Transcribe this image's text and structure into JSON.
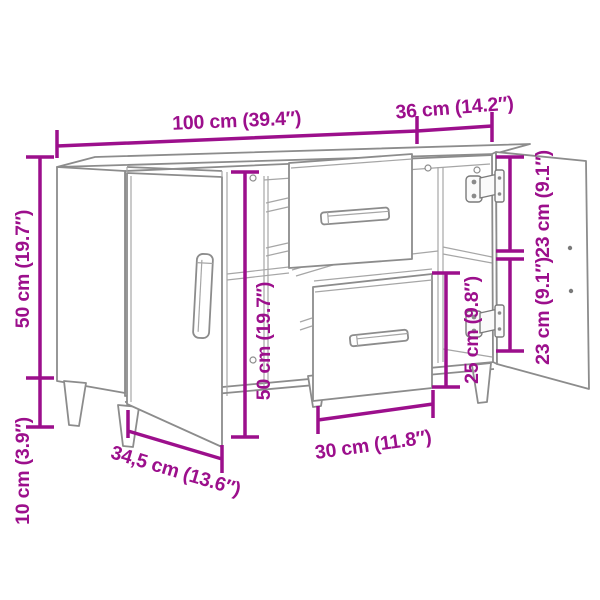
{
  "image": {
    "type": "product-dimension-diagram",
    "subject": "Sideboard with two open doors, two pulled-out drawers and tapered legs",
    "background": "#ffffff",
    "colors": {
      "dimension_annotation": "#9c0f8c",
      "furniture_outline": "#8c8c8c",
      "furniture_outline_light": "#a6a6a6",
      "hinge_hardware": "#7a7a7a"
    },
    "dimensions": {
      "top_width": "100 cm (39.4″)",
      "top_depth": "36 cm (14.2″)",
      "body_height": "50 cm (19.7″)",
      "leg_height": "10 cm (3.9″)",
      "interior_height": "50 cm (19.7″)",
      "upper_compartment_height": "23 cm (9.1″)",
      "lower_compartment_height": "23 cm (9.1″)",
      "drawer_front_height": "25 cm (9.8″)",
      "drawer_width": "30 cm (11.8″)",
      "door_width": "34,5 cm (13.6″)"
    }
  }
}
